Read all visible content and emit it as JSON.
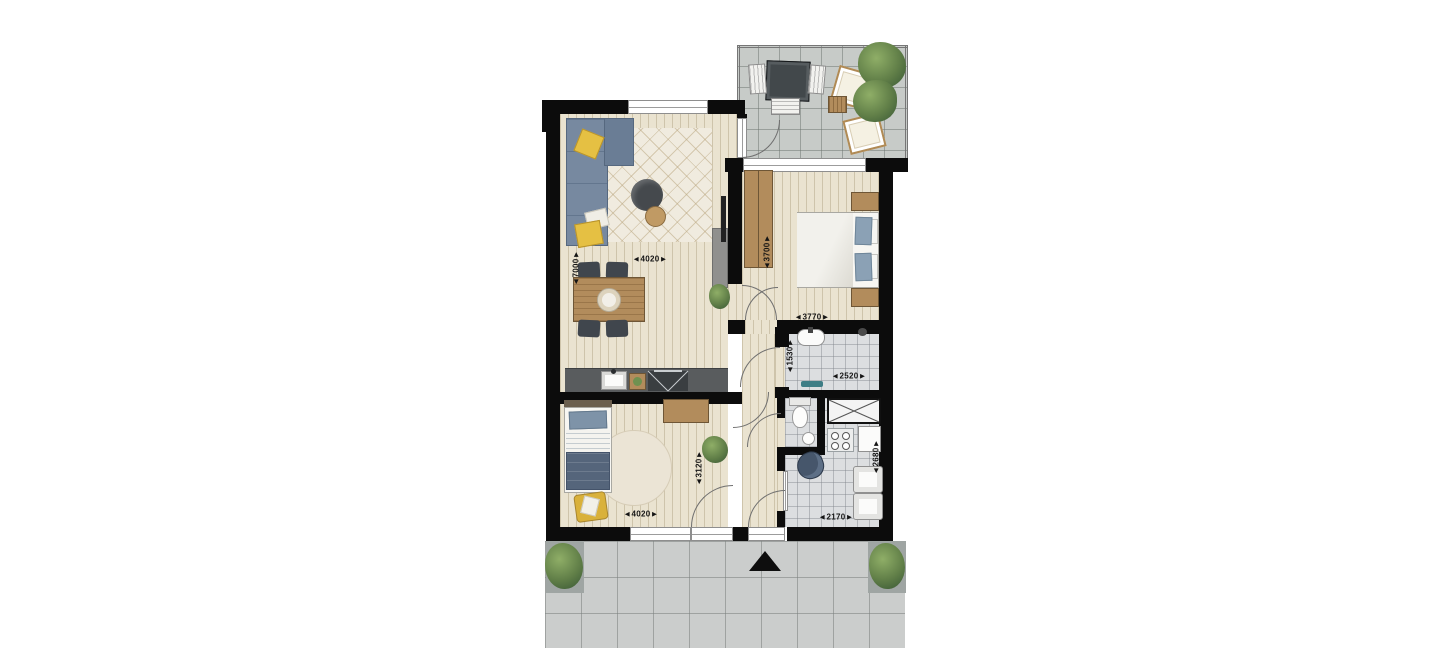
{
  "floor_plan": {
    "dimension_labels": {
      "living_height": "◄7000►",
      "living_width": "◄4020►",
      "bedroom_1_depth": "◄3700►",
      "bedroom_1_width": "◄3770►",
      "bathroom_depth": "◄1530►",
      "bathroom_width": "◄2520►",
      "bedroom_2_depth": "◄3120►",
      "bedroom_2_width": "◄4020►",
      "utility_depth": "◄2680►",
      "utility_width": "◄2170►"
    },
    "icons": {
      "entrance_marker": "solid-black-triangle-up",
      "shaft": "box-with-diagonal-cross",
      "cooktop": "dark-hob-with-cross-lines",
      "plant": "green-foliage-blob"
    },
    "colors": {
      "wall": "#0c0c0c",
      "wood_floor": "#eae3d0",
      "wet_room_tile": "#dcdee0",
      "balcony_tile": "#c7cbc8",
      "terrace_tile": "#cbcdcc",
      "sofa_blue": "#7789a0",
      "bedding_blue": "#8ba1b5",
      "accent_yellow": "#e5c043",
      "wood_furniture": "#b28c5c",
      "plant_green": "#617f48",
      "fixture_teal": "#3e7d85"
    }
  }
}
